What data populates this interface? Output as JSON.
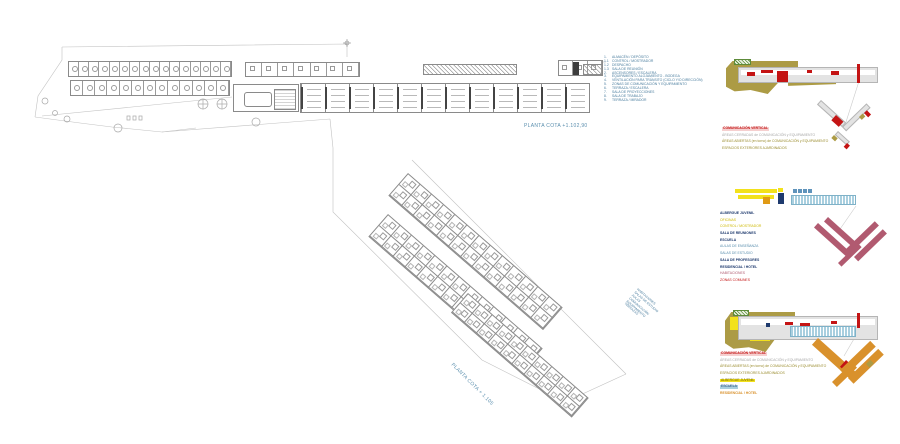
{
  "colors": {
    "khaki": "#ac9b45",
    "red": "#c41414",
    "green_hatch": "#5d8b3a",
    "bar_gray": "#e3e3e3",
    "bar_gray_border": "#b5b5b5",
    "navy": "#1e3a6e",
    "yellow": "#f2e11c",
    "orange": "#e09a15",
    "light_blue": "#a9cfdf",
    "light_blue_stripe": "#7fb2c8",
    "blue_sq": "#5e93bb",
    "maroon": "#b15a70",
    "orange_bar": "#d9912c",
    "label_blue": "#5b8fae",
    "legend_text": "#4a7d9e",
    "text_olive": "#9a8c2e"
  },
  "upper_plan": {
    "label": "PLANTA COTA +1.102,90",
    "hotel_rooms_top": 16,
    "hotel_rooms_lower": 13,
    "pod_rooms": 7,
    "classrooms": 12,
    "right_rooms": 3
  },
  "legend": {
    "items": [
      {
        "num": "1.",
        "label": "ALMACÉN / DEPÓSITO"
      },
      {
        "num": "1.1",
        "label": "CONTROL / MOSTRADOR"
      },
      {
        "num": "1.2",
        "label": "DESPACHO"
      },
      {
        "num": "1.3",
        "label": "SALA DE REUNIÓN"
      },
      {
        "num": "2.",
        "label": "ASCENSORES / ESCALERA"
      },
      {
        "num": "3.",
        "label": "EQUIPAMIENTO ALOJAMIENTO - BODEGA"
      },
      {
        "num": "4.",
        "label": "VENTILACIÓN PARA TRÁNSITO (CICLO Y/O DIRECCIÓN)"
      },
      {
        "num": "5.",
        "label": "ZONAS DE COMUNICACIÓN Y EQUIPAMIENTO"
      },
      {
        "num": "6.",
        "label": "TERRAZA / ESCALERA"
      },
      {
        "num": "7.",
        "label": "SALA DE PROYECCIONES"
      },
      {
        "num": "8.",
        "label": "SALA DE TRABAJO"
      },
      {
        "num": "9.",
        "label": "TERRAZA / MIRADOR"
      }
    ]
  },
  "lower_plan": {
    "label": "PLANTA COTA + 1.105",
    "wing1_cells": 13,
    "wing2_cells": 13,
    "wing3_cells": 10,
    "notes": [
      "HABITACIONES",
      "SALAS DE ESTUDIO",
      "AULAS",
      "COMUNICACIÓN",
      "EQUIPAMIENTO",
      "TERRAZAS"
    ]
  },
  "diagram1": {
    "legend": [
      {
        "text": "COMUNICACIÓN VERTICAL",
        "style": "red-hl"
      },
      {
        "text": "ÁREAS CERRADAS de COMUNICACIÓN y EQUIPAMIENTO",
        "style": "gray"
      },
      {
        "text": "ÁREAS ABIERTAS (en torno) de COMUNICACIÓN y EQUIPAMIENTO",
        "style": "olive"
      },
      {
        "text": "ESPACIOS EXTERIORES AJARDINADOS",
        "style": "olive"
      }
    ]
  },
  "diagram2": {
    "window_squares": 4,
    "legend": [
      {
        "text": "ALBERGUE JUVENIL",
        "style": "header"
      },
      {
        "text": "OFICINAS",
        "style": "yellow-tx"
      },
      {
        "text": "CONTROL / MOSTRADOR",
        "style": "yellow-tx"
      },
      {
        "text": "SALA DE REUNIONES",
        "style": "header"
      },
      {
        "text": "ESCUELA",
        "style": "header"
      },
      {
        "text": "AULAS DE ENSEÑANZA",
        "style": "blue-tx"
      },
      {
        "text": "SALAS DE ESTUDIO",
        "style": "blue-tx"
      },
      {
        "text": "SALA DE PROFESORES",
        "style": "header"
      },
      {
        "text": "RESIDENCIAL / HOTEL",
        "style": "header"
      },
      {
        "text": "HABITACIONES",
        "style": "pink-tx"
      },
      {
        "text": "ZONAS COMUNES",
        "style": "red-tx"
      }
    ]
  },
  "diagram3": {
    "legend": [
      {
        "text": "COMUNICACIÓN VERTICAL",
        "style": "red-hl"
      },
      {
        "text": "ÁREAS CERRADAS de COMUNICACIÓN y EQUIPAMIENTO",
        "style": "gray"
      },
      {
        "text": "ÁREAS ABIERTAS (en torno) de COMUNICACIÓN y EQUIPAMIENTO",
        "style": "olive"
      },
      {
        "text": "ESPACIOS EXTERIORES AJARDINADOS",
        "style": "olive"
      },
      {
        "text": "ALBERGUE JUVENIL",
        "style": "yellow-bg"
      },
      {
        "text": "ESCUELA",
        "style": "blue-bg"
      },
      {
        "text": "RESIDENCIAL / HOTEL",
        "style": "orange-tx"
      }
    ]
  }
}
